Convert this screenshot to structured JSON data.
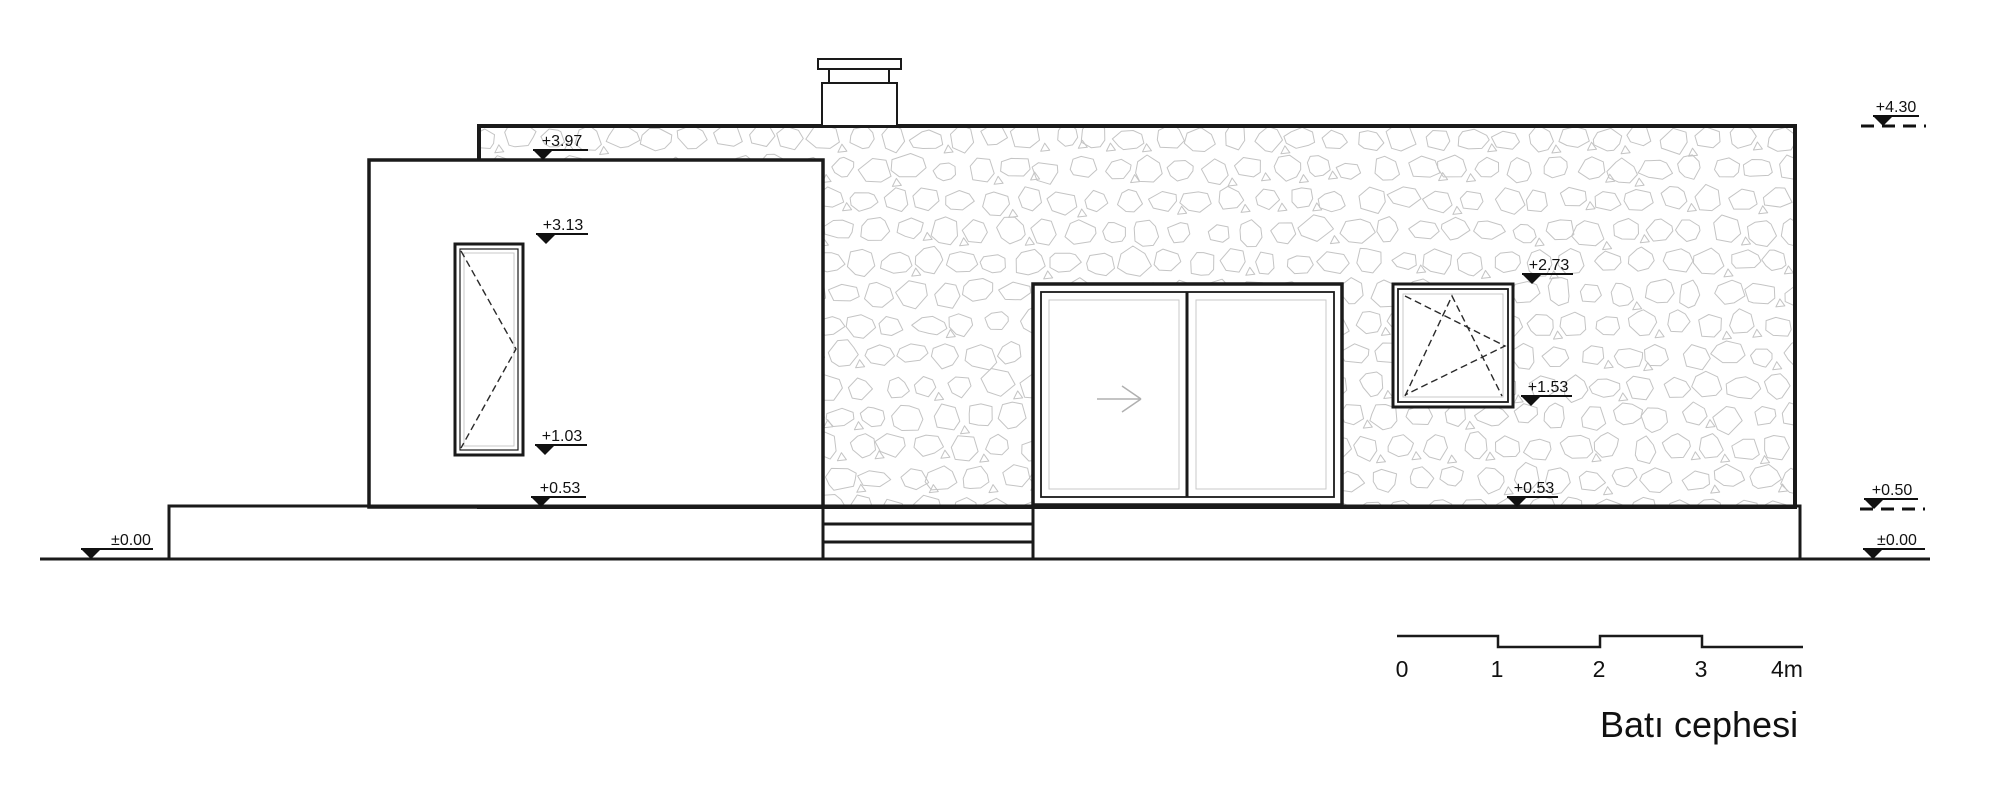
{
  "drawing": {
    "title": "Batı cephesi"
  },
  "markers": {
    "ground_left": "±0.00",
    "parapet_front": "+3.97",
    "left_window_top": "+3.13",
    "left_window_sill": "+1.03",
    "floor_left": "+0.53",
    "right_window_top": "+2.73",
    "right_window_sill": "+1.53",
    "floor_right": "+0.53",
    "roof_top": "+4.30",
    "terrace_level": "+0.50",
    "ground_right": "±0.00"
  },
  "scale_bar": {
    "labels": [
      "0",
      "1",
      "2",
      "3",
      "4m"
    ]
  },
  "colors": {
    "line": "#1a1a1a",
    "stone_outline": "#c4c4c4",
    "glass_detail": "#c9c9c9",
    "arrow": "#b0b0b0",
    "background": "#ffffff"
  }
}
